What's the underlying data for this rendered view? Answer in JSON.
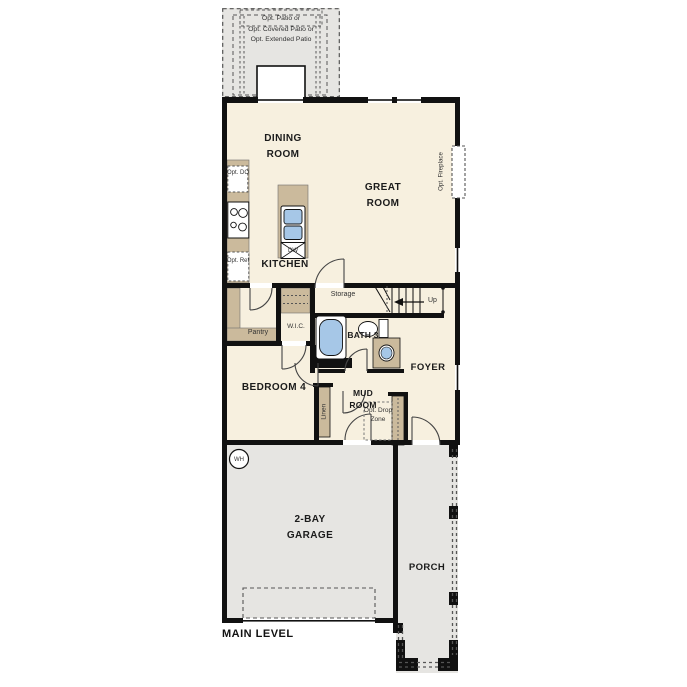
{
  "plan": {
    "title": "MAIN LEVEL",
    "rooms": {
      "dining_room": "DINING ROOM",
      "great_room": "GREAT ROOM",
      "kitchen": "KITCHEN",
      "bedroom_4": "BEDROOM 4",
      "bath_3": "BATH 3",
      "mud_room": "MUD ROOM",
      "foyer": "FOYER",
      "garage": "2-BAY GARAGE",
      "porch": "PORCH",
      "wic": "W.I.C.",
      "pantry": "Pantry",
      "storage": "Storage",
      "linen": "Linen"
    },
    "options": {
      "patio_line_1": "Opt. Patio or",
      "patio_line_2": "Opt. Covered Patio or",
      "patio_line_3": "Opt. Extended Patio",
      "fireplace": "Opt. Fireplace",
      "double_oven": "Opt. DO",
      "refrigerator": "Opt. Ref",
      "drop_zone": "Opt. Drop Zone"
    },
    "fixtures": {
      "dishwasher": "DW",
      "water_heater": "WH",
      "stairs_direction": "Up"
    },
    "colors": {
      "floor_cream": "#f7f0df",
      "floor_gray": "#e6e5e2",
      "cabinet_tan": "#cbba9c",
      "fixture_blue": "#a6c7e7",
      "wall_black": "#111111"
    }
  }
}
